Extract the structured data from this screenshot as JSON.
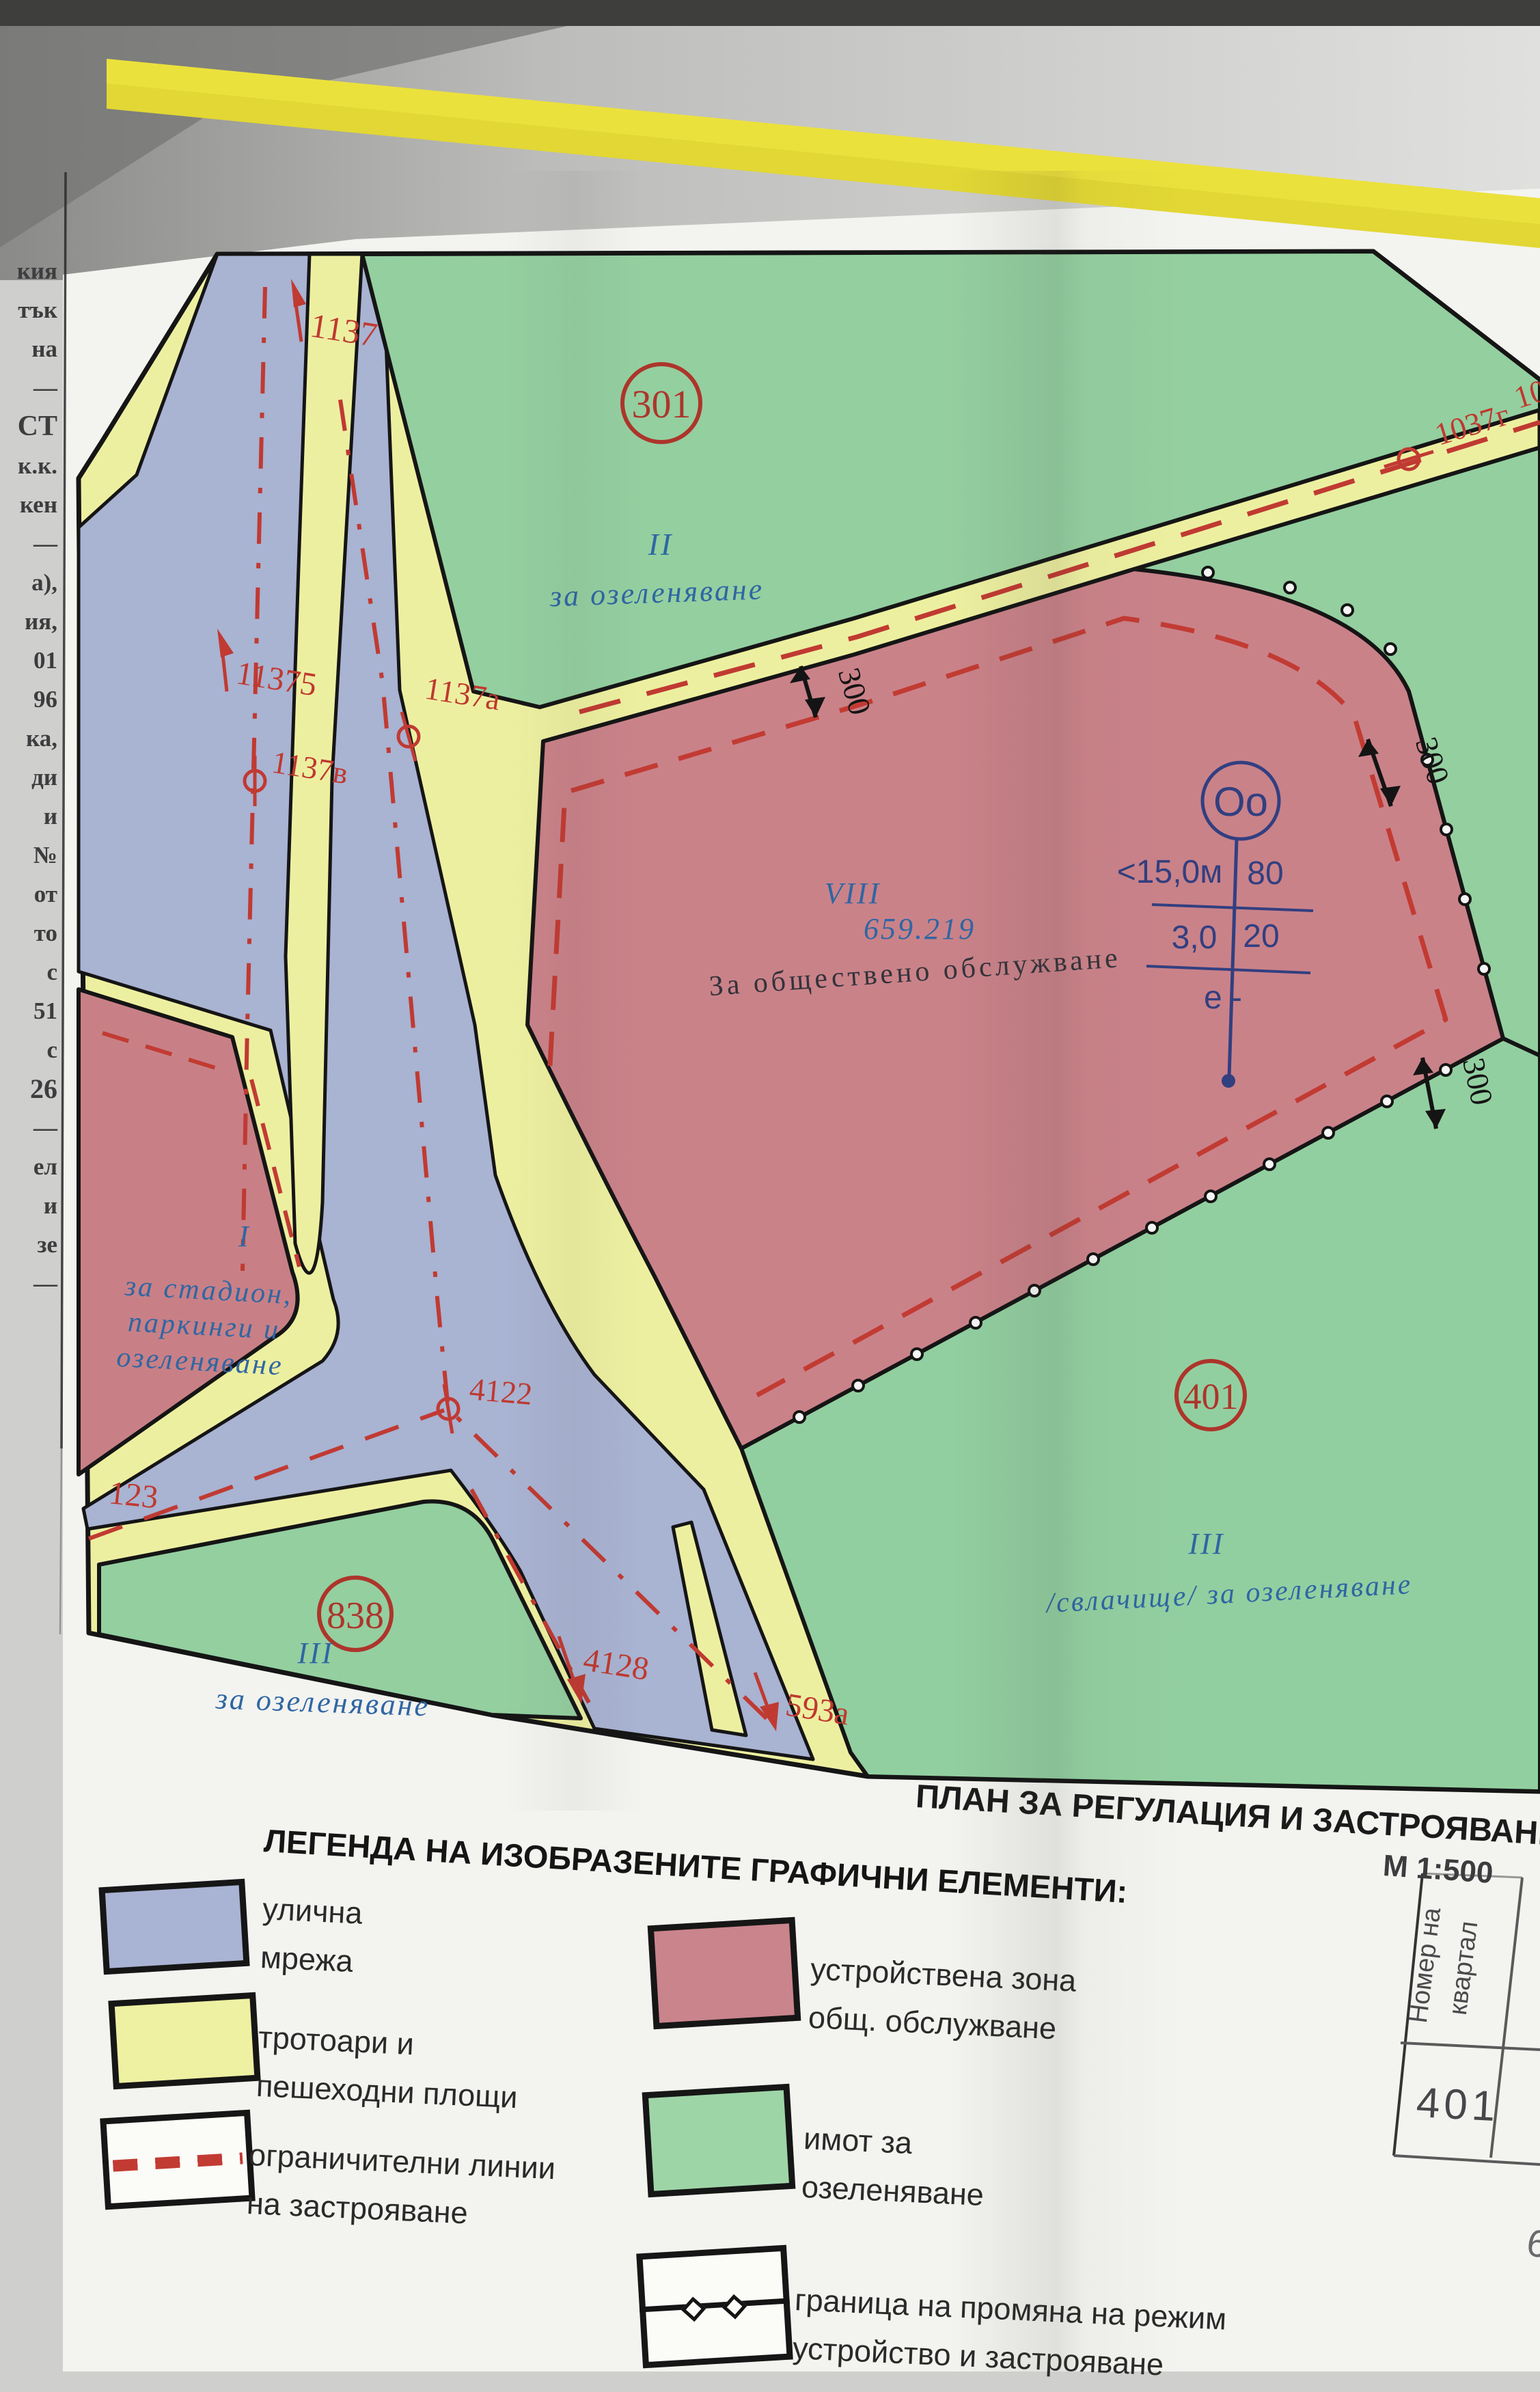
{
  "page_title": "ПЛАН ЗА РЕГУЛАЦИЯ И ЗАСТРОЯВАНЕ",
  "scale": "М 1:500",
  "legend": {
    "header": "ЛЕГЕНДА НА ИЗОБРАЗЕНИТЕ ГРАФИЧНИ ЕЛЕМЕНТИ:",
    "items": [
      {
        "key": "street-network",
        "lines": [
          "улична",
          "мрежа"
        ]
      },
      {
        "key": "sidewalks",
        "lines": [
          "тротоари и",
          "пешеходни площи"
        ]
      },
      {
        "key": "building-limit-lines",
        "lines": [
          "ограничителни линии",
          "на застрояване"
        ]
      },
      {
        "key": "service-zone",
        "lines": [
          "устройствена зона",
          "общ. обслужване"
        ]
      },
      {
        "key": "greenery-property",
        "lines": [
          "имот за",
          "озеленяване"
        ]
      },
      {
        "key": "regime-boundary",
        "lines": [
          "граница на промяна на режим",
          "устройство и застрояване"
        ]
      }
    ]
  },
  "block_table": {
    "header_line1": "Номер на",
    "header_line2": "квартал",
    "value": "401",
    "partial": "6"
  },
  "margin_fragments": [
    "кия",
    "тък",
    "на",
    "—",
    "СТ",
    "к.к.",
    "кен",
    "—",
    "а),",
    "ия,",
    "01",
    "96",
    "ка,",
    "ди",
    "и",
    "№",
    "от",
    "то",
    "с",
    "51",
    "с",
    "26",
    "—",
    "ел",
    "и",
    "зе",
    "—"
  ],
  "map": {
    "labels": {
      "l1137": "1137",
      "l11375": "11375",
      "l1137a": "1137а",
      "l1137v": "1137в",
      "l1037g": "1037г",
      "l10": "10",
      "l4122": "4122",
      "l123": "123",
      "l4128": "4128",
      "l593a": "593а",
      "dim300": "300"
    },
    "blocks": {
      "b301": "301",
      "b838": "838",
      "b401": "401"
    },
    "zones": {
      "green_top_numeral": "II",
      "green_top_use": "за озеленяване",
      "red_viii_numeral": "VIII",
      "red_viii_area": "659.219",
      "red_viii_use": "За обществено обслужване",
      "red_i_numeral": "I",
      "red_i_line1": "за стадион,",
      "red_i_line2": "паркинги и",
      "red_i_line3": "озеленяване",
      "green_838_numeral": "III",
      "green_838_use": "за озеленяване",
      "green_401_numeral": "III",
      "green_401_use": "/свлачище/  за озеленяване"
    },
    "indicator": {
      "circle": "Oo",
      "height": "<15,0м",
      "density": "80",
      "floors": "3,0",
      "intensity": "20",
      "note": "е -"
    },
    "colors": {
      "street": "#a9b3d2",
      "sidewalk": "#edefa0",
      "greenery": "#94cfa0",
      "service_zone": "#ca8289",
      "red_line": "#c03a32",
      "navy": "#323f80",
      "zone_text_blue": "#2f66a3"
    }
  }
}
